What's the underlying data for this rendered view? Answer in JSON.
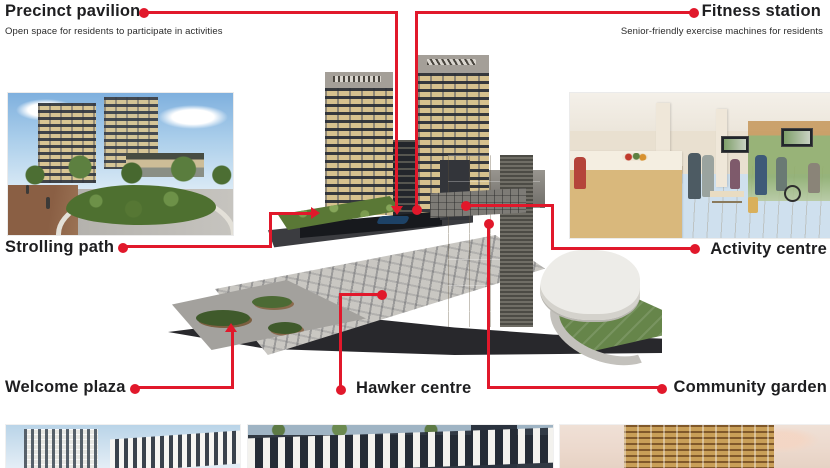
{
  "accent_color": "#e1182b",
  "text_color": "#1e1e20",
  "callouts": {
    "precinct_pavilion": {
      "label": "Precinct pavilion",
      "description": "Open space for residents to participate in activities"
    },
    "fitness_station": {
      "label": "Fitness station",
      "description": "Senior-friendly exercise machines for residents"
    },
    "strolling_path": {
      "label": "Strolling path"
    },
    "activity_centre": {
      "label": "Activity centre"
    },
    "welcome_plaza": {
      "label": "Welcome plaza"
    },
    "hawker_centre": {
      "label": "Hawker centre"
    },
    "community_garden": {
      "label": "Community garden"
    }
  },
  "figures": {
    "strolling_path_photo": "strolling-path-photo",
    "activity_centre_photo": "activity-centre-photo",
    "site_model": "development-cutaway-model",
    "thumbnails": [
      "development-thumbnail-1",
      "development-thumbnail-2",
      "development-thumbnail-3"
    ]
  }
}
